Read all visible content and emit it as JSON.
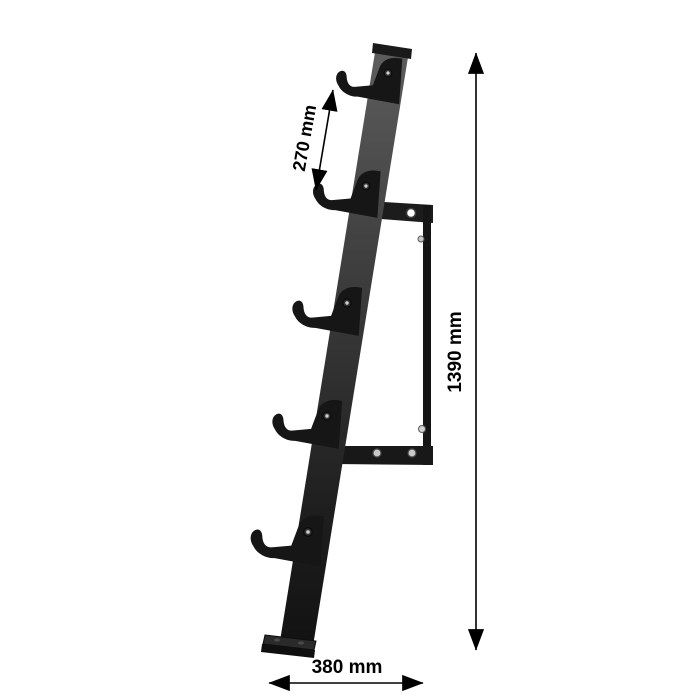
{
  "diagram": {
    "type": "product-dimension-diagram",
    "subject": "wall-mounted barbell holder rack, side view",
    "hook_count": 5
  },
  "dimensions": {
    "hook_spacing_label": "270 mm",
    "total_height_label": "1390 mm",
    "base_depth_label": "380 mm"
  },
  "colors": {
    "background": "#ffffff",
    "steel_light": "#5a5a5a",
    "steel_dark": "#141414",
    "hook_black": "#161616",
    "annotation": "#000000",
    "bolt_silver": "#c6c6c6"
  }
}
